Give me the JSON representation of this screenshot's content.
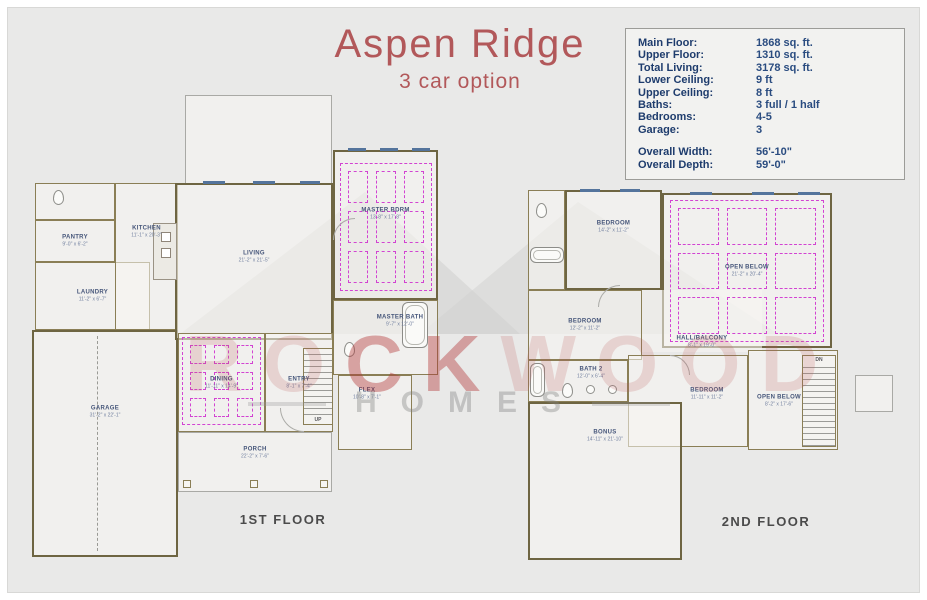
{
  "title": {
    "text": "Aspen Ridge",
    "subtitle": "3 car option"
  },
  "colors": {
    "accent_red": "#b2585a",
    "navy": "#1e3c6d",
    "ceiling_grid_magenta": "#d243d2",
    "wall_olive": "#6e6542"
  },
  "info_box": {
    "rows": [
      {
        "label": "Main Floor:",
        "value": "1868 sq. ft."
      },
      {
        "label": "Upper Floor:",
        "value": "1310 sq. ft."
      },
      {
        "label": "Total Living:",
        "value": "3178 sq. ft."
      },
      {
        "label": "Lower Ceiling:",
        "value": "9 ft"
      },
      {
        "label": "Upper Ceiling:",
        "value": "8 ft"
      },
      {
        "label": "Baths:",
        "value": "3 full / 1 half"
      },
      {
        "label": "Bedrooms:",
        "value": "4-5"
      },
      {
        "label": "Garage:",
        "value": "3"
      },
      {
        "label": "",
        "value": ""
      },
      {
        "label": "Overall Width:",
        "value": "56'-10\""
      },
      {
        "label": "Overall Depth:",
        "value": "59'-0\""
      }
    ]
  },
  "watermark": {
    "part1": "RO",
    "part2": "CK",
    "part3": "WOOD",
    "line2": "HOMES"
  },
  "floors": [
    {
      "id": "floor1",
      "caption": "1ST FLOOR",
      "rooms": [
        {
          "id": "patio",
          "wall": "thin",
          "x": 157,
          "y": 5,
          "w": 147,
          "h": 90
        },
        {
          "id": "garage",
          "label": "GARAGE",
          "dims": "31'-2\" x 22'-1\"",
          "wall": "outer",
          "x": 4,
          "y": 240,
          "w": 146,
          "h": 227,
          "lcy": 80
        },
        {
          "id": "powder-bath",
          "wall": "inner",
          "x": 7,
          "y": 93,
          "w": 80,
          "h": 37
        },
        {
          "id": "pantry",
          "label": "PANTRY",
          "dims": "9'-0\" x 6'-2\"",
          "wall": "inner",
          "x": 7,
          "y": 130,
          "w": 80,
          "h": 42
        },
        {
          "id": "laundry",
          "label": "LAUNDRY",
          "dims": "11'-2\" x 6'-7\"",
          "wall": "inner",
          "x": 7,
          "y": 172,
          "w": 115,
          "h": 68,
          "lcy": 33
        },
        {
          "id": "kitchen",
          "label": "KITCHEN",
          "dims": "11'-1\" x 20'-3\"",
          "wall": "inner",
          "x": 87,
          "y": 93,
          "w": 63,
          "h": 147,
          "lcy": 48
        },
        {
          "id": "living",
          "label": "LIVING",
          "dims": "21'-2\" x 21'-5\"",
          "wall": "outer",
          "x": 147,
          "y": 93,
          "w": 158,
          "h": 157,
          "lcy": 72
        },
        {
          "id": "master-bdrm",
          "label": "MASTER BDRM",
          "dims": "13'-8\" x 17'-8\"",
          "wall": "outer",
          "x": 305,
          "y": 60,
          "w": 105,
          "h": 150,
          "lcy": 62
        },
        {
          "id": "master-bath",
          "label": "MASTER BATH",
          "dims": "9'-7\" x 12'-0\"",
          "wall": "inner",
          "x": 305,
          "y": 210,
          "w": 105,
          "h": 75,
          "lcx": 66,
          "lcy": 20
        },
        {
          "id": "dining",
          "label": "DINING",
          "dims": "11'-11\" x 14'-9\"",
          "wall": "inner",
          "x": 150,
          "y": 243,
          "w": 87,
          "h": 99
        },
        {
          "id": "entry",
          "label": "ENTRY",
          "dims": "8'-1\" x 7'-4\"",
          "wall": "inner",
          "x": 237,
          "y": 243,
          "w": 68,
          "h": 99
        },
        {
          "id": "flex",
          "label": "FLEX",
          "dims": "10'-8\" x 7'-1\"",
          "wall": "inner",
          "x": 310,
          "y": 285,
          "w": 74,
          "h": 75,
          "lcx": 28,
          "lcy": 18
        },
        {
          "id": "porch",
          "label": "PORCH",
          "dims": "22'-2\" x 7'-6\"",
          "wall": "thin",
          "x": 150,
          "y": 342,
          "w": 154,
          "h": 60,
          "lcy": 20
        }
      ],
      "grids": [
        {
          "x": 154,
          "y": 247,
          "w": 79,
          "h": 88
        },
        {
          "x": 312,
          "y": 73,
          "w": 92,
          "h": 128
        }
      ],
      "stairs": [
        {
          "x": 275,
          "y": 258,
          "w": 30,
          "h": 77,
          "label": "UP",
          "at": "bottom"
        }
      ],
      "windows": [
        {
          "x": 175,
          "y": 91,
          "w": 22
        },
        {
          "x": 225,
          "y": 91,
          "w": 22
        },
        {
          "x": 272,
          "y": 91,
          "w": 20
        },
        {
          "x": 320,
          "y": 58,
          "w": 18
        },
        {
          "x": 352,
          "y": 58,
          "w": 18
        },
        {
          "x": 384,
          "y": 58,
          "w": 18
        }
      ],
      "fixtures": [
        {
          "t": "toilet",
          "x": 25,
          "y": 100
        },
        {
          "t": "island",
          "x": 125,
          "y": 133,
          "w": 24,
          "h": 57
        },
        {
          "t": "tub",
          "x": 374,
          "y": 212,
          "w": 26,
          "h": 46
        },
        {
          "t": "toilet",
          "x": 316,
          "y": 252
        },
        {
          "t": "post",
          "x": 155,
          "y": 390
        },
        {
          "t": "post",
          "x": 222,
          "y": 390
        },
        {
          "t": "post",
          "x": 292,
          "y": 390
        },
        {
          "t": "dashv",
          "x": 69,
          "y": 246,
          "h": 215
        }
      ],
      "arcs": [
        {
          "x": 252,
          "y": 318,
          "r": 24,
          "c": "bl"
        },
        {
          "x": 305,
          "y": 128,
          "r": 22,
          "c": "tl"
        }
      ]
    },
    {
      "id": "floor2",
      "caption": "2ND FLOOR",
      "rooms": [
        {
          "id": "bath-3",
          "wall": "inner",
          "x": 8,
          "y": 5,
          "w": 37,
          "h": 100
        },
        {
          "id": "bedroom-2",
          "label": "BEDROOM",
          "dims": "14'-2\" x 11'-2\"",
          "wall": "outer",
          "x": 45,
          "y": 5,
          "w": 97,
          "h": 100,
          "lcy": 35
        },
        {
          "id": "open-below-main",
          "label": "OPEN BELOW",
          "dims": "21'-2\" x 20'-4\"",
          "wall": "outer",
          "x": 142,
          "y": 8,
          "w": 170,
          "h": 155
        },
        {
          "id": "bedroom-3",
          "label": "BEDROOM",
          "dims": "12'-2\" x 11'-2\"",
          "wall": "inner",
          "x": 8,
          "y": 105,
          "w": 114,
          "h": 70
        },
        {
          "id": "hall-balcony",
          "label": "HALL/BALCONY",
          "dims": "8'-1\" x 19'-0\"",
          "wall": "none",
          "x": 122,
          "y": 105,
          "w": 120,
          "h": 62,
          "lcy": 52
        },
        {
          "id": "bath-2",
          "label": "BATH 2",
          "dims": "12'-0\" x 6'-4\"",
          "wall": "inner",
          "x": 8,
          "y": 175,
          "w": 100,
          "h": 42,
          "lcx": 62,
          "lcy": 12
        },
        {
          "id": "bedroom-4",
          "label": "BEDROOM",
          "dims": "11'-11\" x 11'-2\"",
          "wall": "inner",
          "x": 108,
          "y": 170,
          "w": 120,
          "h": 92,
          "lcx": 78,
          "lcy": 38
        },
        {
          "id": "open-below-stair",
          "label": "OPEN BELOW",
          "dims": "8'-2\" x 17'-6\"",
          "wall": "inner",
          "x": 228,
          "y": 165,
          "w": 90,
          "h": 100,
          "lcx": 30,
          "lcy": 50
        },
        {
          "id": "bonus",
          "label": "BONUS",
          "dims": "14'-11\" x 21'-10\"",
          "wall": "outer",
          "x": 8,
          "y": 217,
          "w": 154,
          "h": 158,
          "lcy": 32
        },
        {
          "id": "nook",
          "wall": "thin",
          "x": 335,
          "y": 190,
          "w": 38,
          "h": 37
        }
      ],
      "grids": [
        {
          "x": 150,
          "y": 15,
          "w": 154,
          "h": 142
        }
      ],
      "stairs": [
        {
          "x": 282,
          "y": 170,
          "w": 34,
          "h": 92,
          "label": "DN",
          "at": "top"
        }
      ],
      "windows": [
        {
          "x": 60,
          "y": 4,
          "w": 20
        },
        {
          "x": 100,
          "y": 4,
          "w": 20
        },
        {
          "x": 170,
          "y": 7,
          "w": 22
        },
        {
          "x": 232,
          "y": 7,
          "w": 22
        },
        {
          "x": 278,
          "y": 7,
          "w": 22
        }
      ],
      "fixtures": [
        {
          "t": "toilet",
          "x": 16,
          "y": 18
        },
        {
          "t": "tub",
          "x": 10,
          "y": 62,
          "w": 34,
          "h": 16
        },
        {
          "t": "tub",
          "x": 10,
          "y": 178,
          "w": 15,
          "h": 34
        },
        {
          "t": "toilet",
          "x": 42,
          "y": 198
        },
        {
          "t": "sink",
          "x": 66,
          "y": 200
        },
        {
          "t": "sink",
          "x": 88,
          "y": 200
        }
      ],
      "arcs": [
        {
          "x": 78,
          "y": 100,
          "r": 22,
          "c": "tl"
        },
        {
          "x": 150,
          "y": 170,
          "r": 20,
          "c": "tr"
        }
      ]
    }
  ]
}
